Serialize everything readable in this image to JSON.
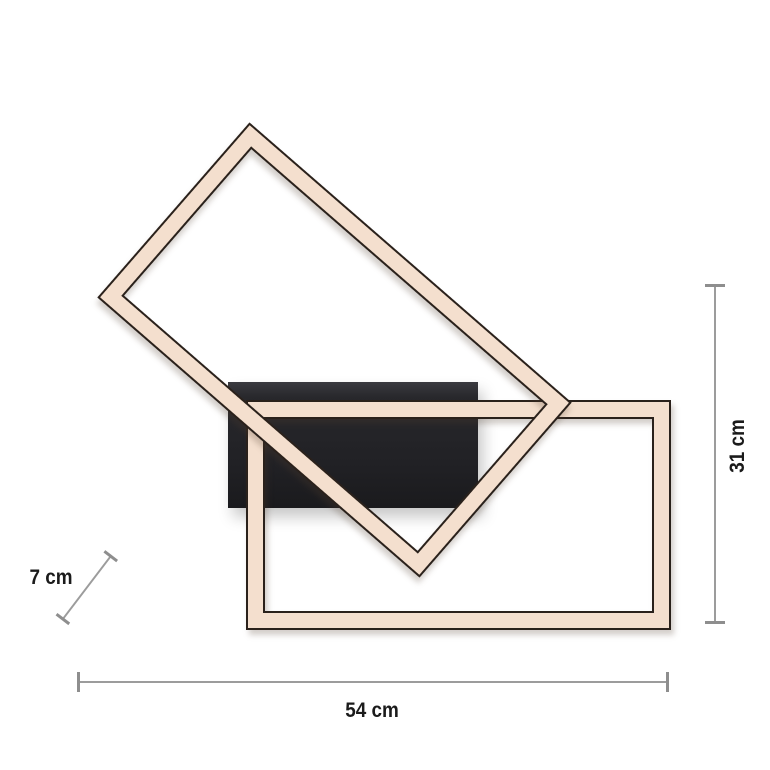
{
  "diagram": {
    "type": "product-dimension-drawing",
    "subject": "LED frame ceiling light: two rectangular light frames (one rotated) on a black mounting plate",
    "dimensions": {
      "width": "54 cm",
      "height": "31 cm",
      "depth": "7 cm"
    },
    "colors": {
      "frame_fill": "#f4dfce",
      "frame_outline": "#2a211b",
      "mounting_plate": "#222226",
      "dimension_line": "#9c9c9c",
      "label_text": "#1b1b1b",
      "background": "#ffffff"
    }
  }
}
